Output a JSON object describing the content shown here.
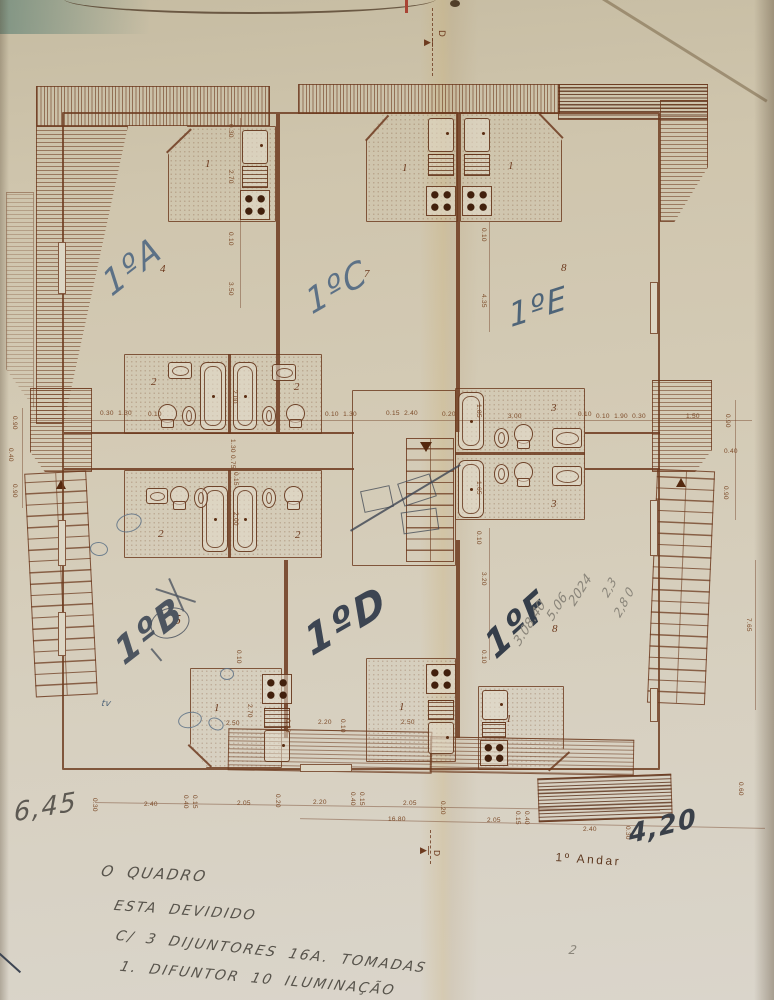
{
  "document": {
    "kind": "scanned architectural floor plan",
    "sheet_label": "1º Andar",
    "section_marker": "D",
    "apartment_units": [
      "1ºA",
      "1ºB",
      "1ºC",
      "1ºD",
      "1ºE",
      "1ºF"
    ],
    "room_numbers_used": [
      1,
      2,
      3,
      4,
      5,
      6,
      7,
      8
    ],
    "handwritten_notes": [
      "O QUADRO",
      "ESTA DEVIDIDO",
      "C/ 3 DIJUNTORES 16A. TOMADAS",
      "1. DIFUNTOR 10 ILUMINAÇÃO"
    ],
    "handwritten_measurements": [
      "6,45",
      "4,20"
    ]
  },
  "palette": {
    "paper": "#d3cab4",
    "ink": "#6d3a1e",
    "pen_blue": "#5c7186",
    "pen_dark": "#3d4552",
    "pencil": "#8a857a"
  },
  "labels": [
    {
      "k": "room",
      "t": "1",
      "x": 205,
      "y": 158
    },
    {
      "k": "room",
      "t": "1",
      "x": 402,
      "y": 162
    },
    {
      "k": "room",
      "t": "1",
      "x": 508,
      "y": 160
    },
    {
      "k": "room",
      "t": "4",
      "x": 160,
      "y": 263
    },
    {
      "k": "room",
      "t": "7",
      "x": 364,
      "y": 268
    },
    {
      "k": "room",
      "t": "8",
      "x": 561,
      "y": 262
    },
    {
      "k": "room",
      "t": "2",
      "x": 151,
      "y": 376
    },
    {
      "k": "room",
      "t": "2",
      "x": 294,
      "y": 381
    },
    {
      "k": "room",
      "t": "3",
      "x": 551,
      "y": 402
    },
    {
      "k": "room",
      "t": "3",
      "x": 551,
      "y": 498
    },
    {
      "k": "room",
      "t": "2",
      "x": 158,
      "y": 528
    },
    {
      "k": "room",
      "t": "2",
      "x": 295,
      "y": 529
    },
    {
      "k": "room",
      "t": "5",
      "x": 174,
      "y": 613,
      "s": 14
    },
    {
      "k": "room",
      "t": "6",
      "x": 359,
      "y": 612
    },
    {
      "k": "room",
      "t": "8",
      "x": 552,
      "y": 623
    },
    {
      "k": "room",
      "t": "1",
      "x": 214,
      "y": 702
    },
    {
      "k": "room",
      "t": "1",
      "x": 399,
      "y": 701
    },
    {
      "k": "room",
      "t": "1",
      "x": 506,
      "y": 713
    },
    {
      "k": "dim",
      "t": "0.30",
      "x": 234,
      "y": 124,
      "r": 90
    },
    {
      "k": "dim",
      "t": "2.70",
      "x": 234,
      "y": 170,
      "r": 90
    },
    {
      "k": "dim",
      "t": "0.10",
      "x": 234,
      "y": 232,
      "r": 90
    },
    {
      "k": "dim",
      "t": "3.50",
      "x": 234,
      "y": 282,
      "r": 90
    },
    {
      "k": "dim",
      "t": "0.10",
      "x": 487,
      "y": 228,
      "r": 90
    },
    {
      "k": "dim",
      "t": "4.35",
      "x": 487,
      "y": 294,
      "r": 90
    },
    {
      "k": "dim",
      "t": "0.30  1.30",
      "x": 100,
      "y": 410
    },
    {
      "k": "dim",
      "t": "0.10",
      "x": 148,
      "y": 411
    },
    {
      "k": "dim",
      "t": "2.00",
      "x": 238,
      "y": 390,
      "r": 90
    },
    {
      "k": "dim",
      "t": "0.10  1.30",
      "x": 325,
      "y": 411
    },
    {
      "k": "dim",
      "t": "0.15  2.40",
      "x": 386,
      "y": 410
    },
    {
      "k": "dim",
      "t": "0.20",
      "x": 442,
      "y": 411
    },
    {
      "k": "dim",
      "t": "1.85",
      "x": 482,
      "y": 404,
      "r": 90
    },
    {
      "k": "dim",
      "t": "3.00",
      "x": 508,
      "y": 413
    },
    {
      "k": "dim",
      "t": "0.10",
      "x": 578,
      "y": 411
    },
    {
      "k": "dim",
      "t": "0.10  1.90  0.30",
      "x": 596,
      "y": 413
    },
    {
      "k": "dim",
      "t": "1.50",
      "x": 686,
      "y": 413
    },
    {
      "k": "dim",
      "t": "1.30",
      "x": 236,
      "y": 439,
      "r": 90
    },
    {
      "k": "dim",
      "t": "0.75",
      "x": 236,
      "y": 455,
      "r": 90
    },
    {
      "k": "dim",
      "t": "1.65",
      "x": 482,
      "y": 481,
      "r": 90
    },
    {
      "k": "dim",
      "t": "0.10",
      "x": 482,
      "y": 531,
      "r": 90
    },
    {
      "k": "dim",
      "t": "0.15",
      "x": 239,
      "y": 472,
      "r": 90
    },
    {
      "k": "dim",
      "t": "2.00",
      "x": 239,
      "y": 512,
      "r": 90
    },
    {
      "k": "dim",
      "t": "3.20",
      "x": 487,
      "y": 572,
      "r": 90
    },
    {
      "k": "dim",
      "t": "0.10",
      "x": 487,
      "y": 650,
      "r": 90
    },
    {
      "k": "dim",
      "t": "0.90",
      "x": 18,
      "y": 416,
      "r": 90
    },
    {
      "k": "dim",
      "t": "0.40",
      "x": 14,
      "y": 448,
      "r": 90
    },
    {
      "k": "dim",
      "t": "0.90",
      "x": 18,
      "y": 484,
      "r": 90
    },
    {
      "k": "dim",
      "t": "0.90",
      "x": 731,
      "y": 414,
      "r": 90
    },
    {
      "k": "dim",
      "t": "0.40",
      "x": 724,
      "y": 448
    },
    {
      "k": "dim",
      "t": "0.90",
      "x": 729,
      "y": 486,
      "r": 90
    },
    {
      "k": "dim",
      "t": "7.65",
      "x": 752,
      "y": 618,
      "r": 90
    },
    {
      "k": "dim",
      "t": "0.60",
      "x": 744,
      "y": 782,
      "r": 90
    },
    {
      "k": "dim",
      "t": "0.10",
      "x": 242,
      "y": 650,
      "r": 90
    },
    {
      "k": "dim",
      "t": "2.50",
      "x": 226,
      "y": 720
    },
    {
      "k": "dim",
      "t": "2.70",
      "x": 253,
      "y": 704,
      "r": 90
    },
    {
      "k": "dim",
      "t": "0.20",
      "x": 291,
      "y": 719,
      "r": 90
    },
    {
      "k": "dim",
      "t": "2.20",
      "x": 318,
      "y": 719
    },
    {
      "k": "dim",
      "t": "0.10",
      "x": 346,
      "y": 719,
      "r": 90
    },
    {
      "k": "dim",
      "t": "2.50",
      "x": 401,
      "y": 719
    },
    {
      "k": "dim",
      "t": "0.30",
      "x": 98,
      "y": 798,
      "r": 90
    },
    {
      "k": "dim",
      "t": "2.40",
      "x": 144,
      "y": 801
    },
    {
      "k": "dim",
      "t": "0.40",
      "x": 189,
      "y": 795,
      "r": 90
    },
    {
      "k": "dim",
      "t": "0.15",
      "x": 198,
      "y": 795,
      "r": 90
    },
    {
      "k": "dim",
      "t": "2.05",
      "x": 237,
      "y": 800
    },
    {
      "k": "dim",
      "t": "0.20",
      "x": 281,
      "y": 794,
      "r": 90
    },
    {
      "k": "dim",
      "t": "2.20",
      "x": 313,
      "y": 799
    },
    {
      "k": "dim",
      "t": "0.40",
      "x": 356,
      "y": 792,
      "r": 90
    },
    {
      "k": "dim",
      "t": "0.15",
      "x": 365,
      "y": 792,
      "r": 90
    },
    {
      "k": "dim",
      "t": "2.05",
      "x": 403,
      "y": 800
    },
    {
      "k": "dim",
      "t": "0.20",
      "x": 446,
      "y": 801,
      "r": 90
    },
    {
      "k": "dim",
      "t": "16.80",
      "x": 388,
      "y": 816
    },
    {
      "k": "dim",
      "t": "2.05",
      "x": 487,
      "y": 817
    },
    {
      "k": "dim",
      "t": "0.15",
      "x": 521,
      "y": 811,
      "r": 90
    },
    {
      "k": "dim",
      "t": "0.40",
      "x": 530,
      "y": 811,
      "r": 90
    },
    {
      "k": "dim",
      "t": "2.40",
      "x": 583,
      "y": 826
    },
    {
      "k": "dim",
      "t": "0.30",
      "x": 631,
      "y": 826,
      "r": 90
    },
    {
      "k": "hand",
      "t": "1ºA",
      "x": 98,
      "y": 272,
      "r": -38,
      "s": 34,
      "c": "#5c7186"
    },
    {
      "k": "hand",
      "t": "1ºC",
      "x": 302,
      "y": 288,
      "r": -30,
      "s": 34,
      "c": "#5c7186"
    },
    {
      "k": "hand",
      "t": "1ºE",
      "x": 507,
      "y": 300,
      "r": -18,
      "s": 32,
      "c": "#4e6478"
    },
    {
      "k": "hand",
      "t": "1ºB",
      "x": 110,
      "y": 640,
      "r": -38,
      "s": 36,
      "c": "#4d5560",
      "w": 600
    },
    {
      "k": "hand",
      "t": "1ºD",
      "x": 300,
      "y": 625,
      "r": -30,
      "s": 40,
      "c": "#3d4552",
      "w": 600
    },
    {
      "k": "hand",
      "t": "1ºF",
      "x": 480,
      "y": 635,
      "r": -42,
      "s": 36,
      "c": "#353e4a",
      "w": 600
    },
    {
      "k": "hand",
      "t": "6,45",
      "x": 14,
      "y": 800,
      "r": -10,
      "s": 26,
      "c": "#5d5952"
    },
    {
      "k": "hand",
      "t": "4,20",
      "x": 628,
      "y": 822,
      "r": -14,
      "s": 26,
      "c": "#3a4049",
      "w": 600
    },
    {
      "k": "hand",
      "t": "tv",
      "x": 102,
      "y": 700,
      "s": 9,
      "c": "#4e6478"
    },
    {
      "k": "pencil",
      "t": "3.08.40",
      "x": 512,
      "y": 640,
      "r": -58
    },
    {
      "k": "pencil",
      "t": "5.06",
      "x": 545,
      "y": 615,
      "r": -58
    },
    {
      "k": "pencil",
      "t": "2024",
      "x": 567,
      "y": 600,
      "r": -58
    },
    {
      "k": "pencil",
      "t": "2,3",
      "x": 600,
      "y": 592,
      "r": -62,
      "s": 12
    },
    {
      "k": "pencil",
      "t": "2,8 0",
      "x": 612,
      "y": 612,
      "r": -62,
      "s": 12
    },
    {
      "k": "pencil",
      "t": "2",
      "x": 570,
      "y": 944,
      "s": 12
    },
    {
      "k": "note",
      "t": "O QUADRO",
      "x": 103,
      "y": 864,
      "r": 3,
      "s": 15
    },
    {
      "k": "note",
      "t": "ESTA DEVIDIDO",
      "x": 116,
      "y": 899,
      "r": 4
    },
    {
      "k": "note",
      "t": "C/ 3 DIJUNTORES 16A. TOMADAS",
      "x": 118,
      "y": 929,
      "r": 6
    },
    {
      "k": "note",
      "t": "1. DIFUNTOR 10 ILUMINAÇÃO",
      "x": 122,
      "y": 960,
      "r": 5
    },
    {
      "k": "print",
      "t": "1º Andar",
      "x": 556,
      "y": 850,
      "r": 4
    },
    {
      "k": "marker",
      "t": "▶|",
      "x": 424,
      "y": 38
    },
    {
      "k": "marker",
      "t": "D",
      "x": 446,
      "y": 30,
      "r": 90
    },
    {
      "k": "marker",
      "t": "▶|",
      "x": 420,
      "y": 846
    },
    {
      "k": "marker",
      "t": "D",
      "x": 441,
      "y": 850,
      "r": 90,
      "s": 8
    }
  ]
}
